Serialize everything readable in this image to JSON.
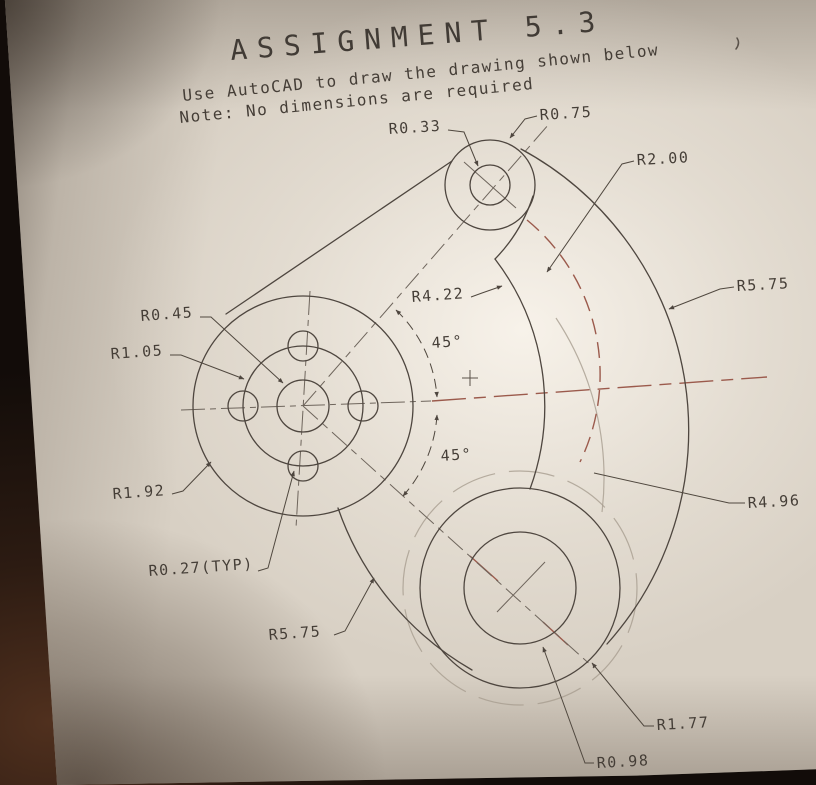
{
  "header": {
    "title": "ASSIGNMENT 5.3",
    "instruction_line1": "Use AutoCAD to draw the drawing shown below",
    "instruction_line2": "Note: No dimensions are required"
  },
  "drawing": {
    "dim_labels": {
      "r0_33": "R0.33",
      "r0_75": "R0.75",
      "r2_00": "R2.00",
      "r5_75_right": "R5.75",
      "r4_22": "R4.22",
      "a45_upper": "45°",
      "a45_lower": "45°",
      "r0_45": "R0.45",
      "r1_05": "R1.05",
      "r1_92": "R1.92",
      "r0_27": "R0.27(TYP)",
      "r5_75_bottom": "R5.75",
      "r4_96": "R4.96",
      "r1_77": "R1.77",
      "r0_98": "R0.98"
    }
  },
  "colors": {
    "paper": "#d8d0c4",
    "ink": "#4e463f",
    "centerline_red": "#9b5a4c",
    "background": "#120c09"
  }
}
